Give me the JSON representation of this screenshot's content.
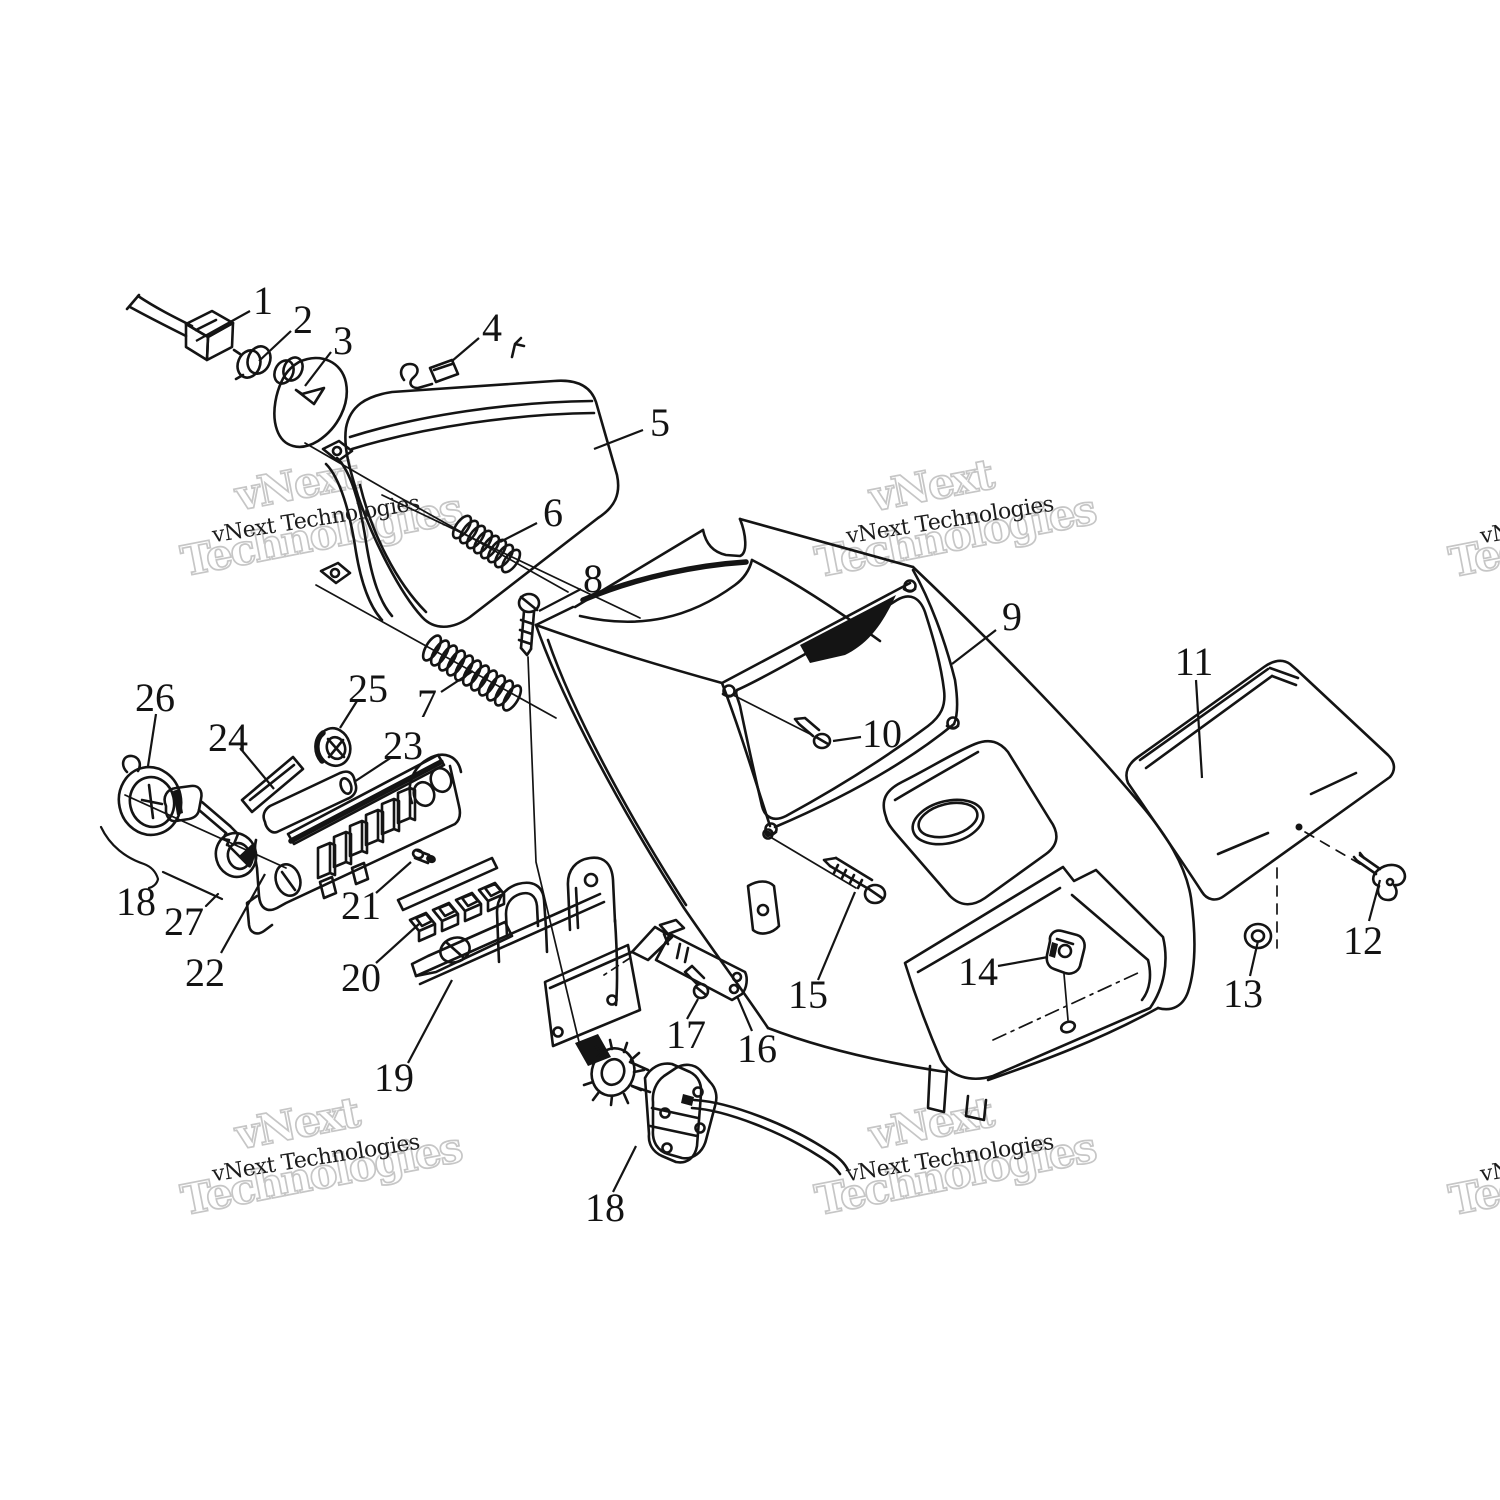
{
  "figure": {
    "background": "#ffffff",
    "line_color": "#141414",
    "width": 1500,
    "height": 1500,
    "description": "Exploded parts diagram: console, headlight housing and switch assembly"
  },
  "watermark": {
    "small_text": "vNext Technologies",
    "outline_line1": "vNext",
    "outline_line2": "Technologies",
    "small_color": "#1c1c1c",
    "outline_color": "#c6c6c6",
    "rotation_deg": -11,
    "tiles": [
      {
        "x": 316,
        "y": 520
      },
      {
        "x": 950,
        "y": 521
      },
      {
        "x": 316,
        "y": 1159
      },
      {
        "x": 950,
        "y": 1159
      },
      {
        "x": 1584,
        "y": 521
      },
      {
        "x": 1584,
        "y": 1159
      }
    ]
  },
  "callouts": [
    {
      "label": "1",
      "x": 263,
      "y": 300,
      "leader": [
        250,
        311,
        196,
        341
      ]
    },
    {
      "label": "2",
      "x": 303,
      "y": 319,
      "leader": [
        291,
        331,
        259,
        361
      ]
    },
    {
      "label": "3",
      "x": 343,
      "y": 340,
      "leader": [
        331,
        352,
        305,
        386
      ]
    },
    {
      "label": "4",
      "x": 492,
      "y": 327,
      "leader": [
        479,
        338,
        452,
        361
      ]
    },
    {
      "label": "5",
      "x": 660,
      "y": 422,
      "leader": [
        643,
        430,
        594,
        449
      ]
    },
    {
      "label": "6",
      "x": 553,
      "y": 512,
      "leader": [
        537,
        523,
        500,
        542
      ]
    },
    {
      "label": "7",
      "x": 427,
      "y": 703,
      "leader": [
        441,
        692,
        473,
        671
      ]
    },
    {
      "label": "8",
      "x": 593,
      "y": 578,
      "leader": [
        581,
        589,
        539,
        611
      ]
    },
    {
      "label": "9",
      "x": 1012,
      "y": 616,
      "leader": [
        996,
        630,
        952,
        664
      ]
    },
    {
      "label": "10",
      "x": 882,
      "y": 733,
      "leader": [
        861,
        737,
        833,
        741
      ]
    },
    {
      "label": "11",
      "x": 1194,
      "y": 661,
      "leader": [
        1196,
        680,
        1202,
        778
      ]
    },
    {
      "label": "12",
      "x": 1363,
      "y": 940,
      "leader": [
        1369,
        921,
        1380,
        880
      ]
    },
    {
      "label": "13",
      "x": 1243,
      "y": 993,
      "leader": [
        1250,
        976,
        1258,
        941
      ]
    },
    {
      "label": "14",
      "x": 978,
      "y": 971,
      "leader": [
        998,
        966,
        1048,
        957
      ]
    },
    {
      "label": "15",
      "x": 808,
      "y": 994,
      "leader": [
        818,
        980,
        855,
        892
      ]
    },
    {
      "label": "16",
      "x": 757,
      "y": 1048,
      "leader": [
        752,
        1031,
        737,
        996
      ]
    },
    {
      "label": "17",
      "x": 686,
      "y": 1034,
      "leader": [
        687,
        1019,
        698,
        999
      ]
    },
    {
      "label": "18",
      "x": 136,
      "y": 901,
      "leader": null
    },
    {
      "label": "18",
      "x": 605,
      "y": 1207,
      "leader": [
        613,
        1192,
        636,
        1146
      ]
    },
    {
      "label": "19",
      "x": 394,
      "y": 1077,
      "leader": [
        408,
        1063,
        452,
        980
      ]
    },
    {
      "label": "20",
      "x": 361,
      "y": 977,
      "leader": [
        376,
        963,
        419,
        924
      ]
    },
    {
      "label": "21",
      "x": 361,
      "y": 905,
      "leader": [
        376,
        893,
        411,
        862
      ]
    },
    {
      "label": "22",
      "x": 205,
      "y": 972,
      "leader": [
        221,
        953,
        265,
        874
      ]
    },
    {
      "label": "23",
      "x": 403,
      "y": 745,
      "leader": [
        392,
        757,
        354,
        782
      ]
    },
    {
      "label": "24",
      "x": 228,
      "y": 737,
      "leader": [
        240,
        748,
        274,
        789
      ]
    },
    {
      "label": "25",
      "x": 368,
      "y": 688,
      "leader": [
        357,
        701,
        340,
        728
      ]
    },
    {
      "label": "26",
      "x": 155,
      "y": 697,
      "leader": [
        156,
        714,
        148,
        766
      ]
    },
    {
      "label": "27",
      "x": 184,
      "y": 921,
      "leader": null
    }
  ]
}
